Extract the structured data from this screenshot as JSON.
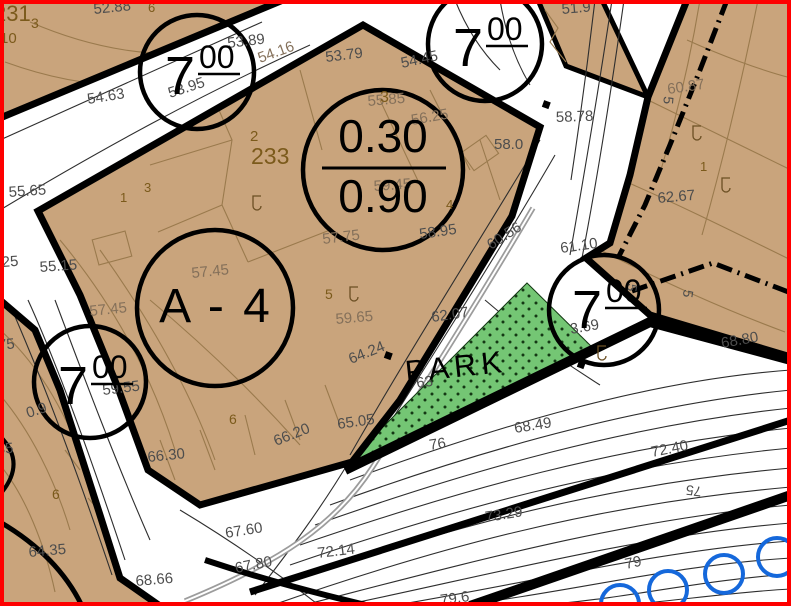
{
  "map_title": "cadastral-zoning-plan",
  "zones": {
    "height_big": "7",
    "height_sup": "00",
    "ratio_top": "0.30",
    "ratio_bottom": "0.90",
    "area_label": "A - 4",
    "park_label": "PARK",
    "block_number": "233"
  },
  "colors": {
    "parcel_fill": "#C9A47C",
    "park_fill": "#74C674",
    "park_dot": "#143814",
    "tree_blue": "#1568DB",
    "frame_red": "#FE0000",
    "elevation_gray": "#4d4d4d",
    "elevation_brown": "#84705A",
    "parcel_brown": "#7B5A1B",
    "contour_brown": "#9A7A4D",
    "contour_dark": "#2E2E2E",
    "boundary_black": "#000000",
    "path_gray": "#9c9c9c"
  },
  "labels": {
    "elevations": [
      {
        "t": "52.88",
        "x": 94,
        "y": 14,
        "r": -6,
        "c": "g"
      },
      {
        "t": "53.89",
        "x": 228,
        "y": 48,
        "r": -7,
        "c": "g"
      },
      {
        "t": "54.63",
        "x": 88,
        "y": 104,
        "r": -9,
        "c": "g"
      },
      {
        "t": "53.95",
        "x": 170,
        "y": 98,
        "r": -18,
        "c": "g"
      },
      {
        "t": "54.16",
        "x": 260,
        "y": 63,
        "r": -20,
        "c": "b"
      },
      {
        "t": "53.79",
        "x": 326,
        "y": 62,
        "r": -7,
        "c": "g"
      },
      {
        "t": "54.45",
        "x": 402,
        "y": 68,
        "r": -12,
        "c": "g"
      },
      {
        "t": "51.9",
        "x": 562,
        "y": 14,
        "r": -5,
        "c": "g"
      },
      {
        "t": "58.78",
        "x": 556,
        "y": 122,
        "r": -2,
        "c": "g"
      },
      {
        "t": "58.0",
        "x": 494,
        "y": 149,
        "r": 0,
        "c": "g"
      },
      {
        "t": "55.85",
        "x": 368,
        "y": 106,
        "r": -5,
        "c": "b"
      },
      {
        "t": "56.25",
        "x": 412,
        "y": 125,
        "r": -10,
        "c": "b"
      },
      {
        "t": "59.45",
        "x": 374,
        "y": 191,
        "r": -4,
        "c": "b"
      },
      {
        "t": "57.75",
        "x": 323,
        "y": 244,
        "r": -7,
        "c": "b"
      },
      {
        "t": "58.95",
        "x": 420,
        "y": 239,
        "r": -8,
        "c": "g"
      },
      {
        "t": "60.56",
        "x": 491,
        "y": 250,
        "r": -33,
        "c": "g"
      },
      {
        "t": "60.87",
        "x": 668,
        "y": 94,
        "r": -8,
        "c": "b"
      },
      {
        "t": "62.67",
        "x": 658,
        "y": 203,
        "r": -5,
        "c": "g"
      },
      {
        "t": "61.10",
        "x": 561,
        "y": 253,
        "r": -8,
        "c": "g"
      },
      {
        "t": "3.69",
        "x": 571,
        "y": 334,
        "r": -10,
        "c": "g"
      },
      {
        "t": "68.80",
        "x": 722,
        "y": 348,
        "r": -10,
        "c": "g"
      },
      {
        "t": "62.07",
        "x": 432,
        "y": 322,
        "r": -8,
        "c": "g"
      },
      {
        "t": "59.65",
        "x": 336,
        "y": 324,
        "r": -5,
        "c": "b"
      },
      {
        "t": "64.24",
        "x": 351,
        "y": 364,
        "r": -22,
        "c": "g"
      },
      {
        "t": "63",
        "x": 417,
        "y": 388,
        "r": -8,
        "c": "g"
      },
      {
        "t": "65.05",
        "x": 338,
        "y": 429,
        "r": -8,
        "c": "g"
      },
      {
        "t": "66.20",
        "x": 276,
        "y": 446,
        "r": -22,
        "c": "g"
      },
      {
        "t": "66.30",
        "x": 148,
        "y": 462,
        "r": -6,
        "c": "g"
      },
      {
        "t": "68.49",
        "x": 515,
        "y": 433,
        "r": -9,
        "c": "g"
      },
      {
        "t": "76",
        "x": 430,
        "y": 450,
        "r": -9,
        "c": "g"
      },
      {
        "t": "59.55",
        "x": 103,
        "y": 395,
        "r": -7,
        "c": "g"
      },
      {
        "t": "0.9",
        "x": 28,
        "y": 418,
        "r": -18,
        "c": "g"
      },
      {
        "t": "57.45",
        "x": 90,
        "y": 316,
        "r": -6,
        "c": "b"
      },
      {
        "t": "57.45",
        "x": 192,
        "y": 278,
        "r": -6,
        "c": "b"
      },
      {
        "t": "55.65",
        "x": 9,
        "y": 197,
        "r": -4,
        "c": "g"
      },
      {
        "t": "25",
        "x": 2,
        "y": 267,
        "r": -4,
        "c": "g"
      },
      {
        "t": "55.15",
        "x": 40,
        "y": 272,
        "r": -4,
        "c": "g"
      },
      {
        "t": "64.35",
        "x": 29,
        "y": 557,
        "r": -5,
        "c": "g"
      },
      {
        "t": "68.66",
        "x": 136,
        "y": 586,
        "r": -5,
        "c": "g"
      },
      {
        "t": "67.60",
        "x": 226,
        "y": 538,
        "r": -9,
        "c": "g"
      },
      {
        "t": "67.80",
        "x": 236,
        "y": 573,
        "r": -11,
        "c": "g"
      },
      {
        "t": "72.14",
        "x": 318,
        "y": 558,
        "r": -7,
        "c": "g"
      },
      {
        "t": "72.40",
        "x": 652,
        "y": 457,
        "r": -11,
        "c": "g"
      },
      {
        "t": "73.29",
        "x": 486,
        "y": 522,
        "r": -9,
        "c": "g"
      },
      {
        "t": "79",
        "x": 626,
        "y": 569,
        "r": -12,
        "c": "g"
      },
      {
        "t": "79.6",
        "x": 441,
        "y": 605,
        "r": -8,
        "c": "g"
      },
      {
        "t": "7.75",
        "x": -14,
        "y": 351,
        "r": -5,
        "c": "g"
      },
      {
        "t": "35",
        "x": -3,
        "y": 454,
        "r": -4,
        "c": "g"
      }
    ],
    "parcels": [
      {
        "t": "231",
        "x": -6,
        "y": 21,
        "s": 22
      },
      {
        "t": "3",
        "x": 31,
        "y": 28,
        "s": 14
      },
      {
        "t": "10",
        "x": 0,
        "y": 43,
        "s": 15
      },
      {
        "t": "6",
        "x": 148,
        "y": 12,
        "s": 13
      },
      {
        "t": "2",
        "x": 250,
        "y": 141,
        "s": 15
      },
      {
        "t": "1",
        "x": 120,
        "y": 202,
        "s": 13
      },
      {
        "t": "3",
        "x": 144,
        "y": 192,
        "s": 13
      },
      {
        "t": "233",
        "x": 251,
        "y": 164,
        "s": 23
      },
      {
        "t": "3",
        "x": 380,
        "y": 102,
        "s": 16
      },
      {
        "t": "4",
        "x": 446,
        "y": 209,
        "s": 13
      },
      {
        "t": "5",
        "x": 325,
        "y": 299,
        "s": 14
      },
      {
        "t": "6",
        "x": 229,
        "y": 424,
        "s": 14
      },
      {
        "t": "6",
        "x": 52,
        "y": 499,
        "s": 14
      },
      {
        "t": "1",
        "x": 700,
        "y": 171,
        "s": 13
      }
    ],
    "contour_index": [
      {
        "t": "5",
        "x": 664,
        "y": 96,
        "r": 95
      },
      {
        "t": "5",
        "x": 628,
        "y": 283,
        "r": 100
      },
      {
        "t": "5",
        "x": 684,
        "y": 289,
        "r": 100
      },
      {
        "t": "75",
        "x": 702,
        "y": 487,
        "r": 187
      }
    ]
  },
  "trees": [
    {
      "cx": 620,
      "cy": 604
    },
    {
      "cx": 668,
      "cy": 590
    },
    {
      "cx": 724,
      "cy": 574
    },
    {
      "cx": 777,
      "cy": 557
    }
  ]
}
